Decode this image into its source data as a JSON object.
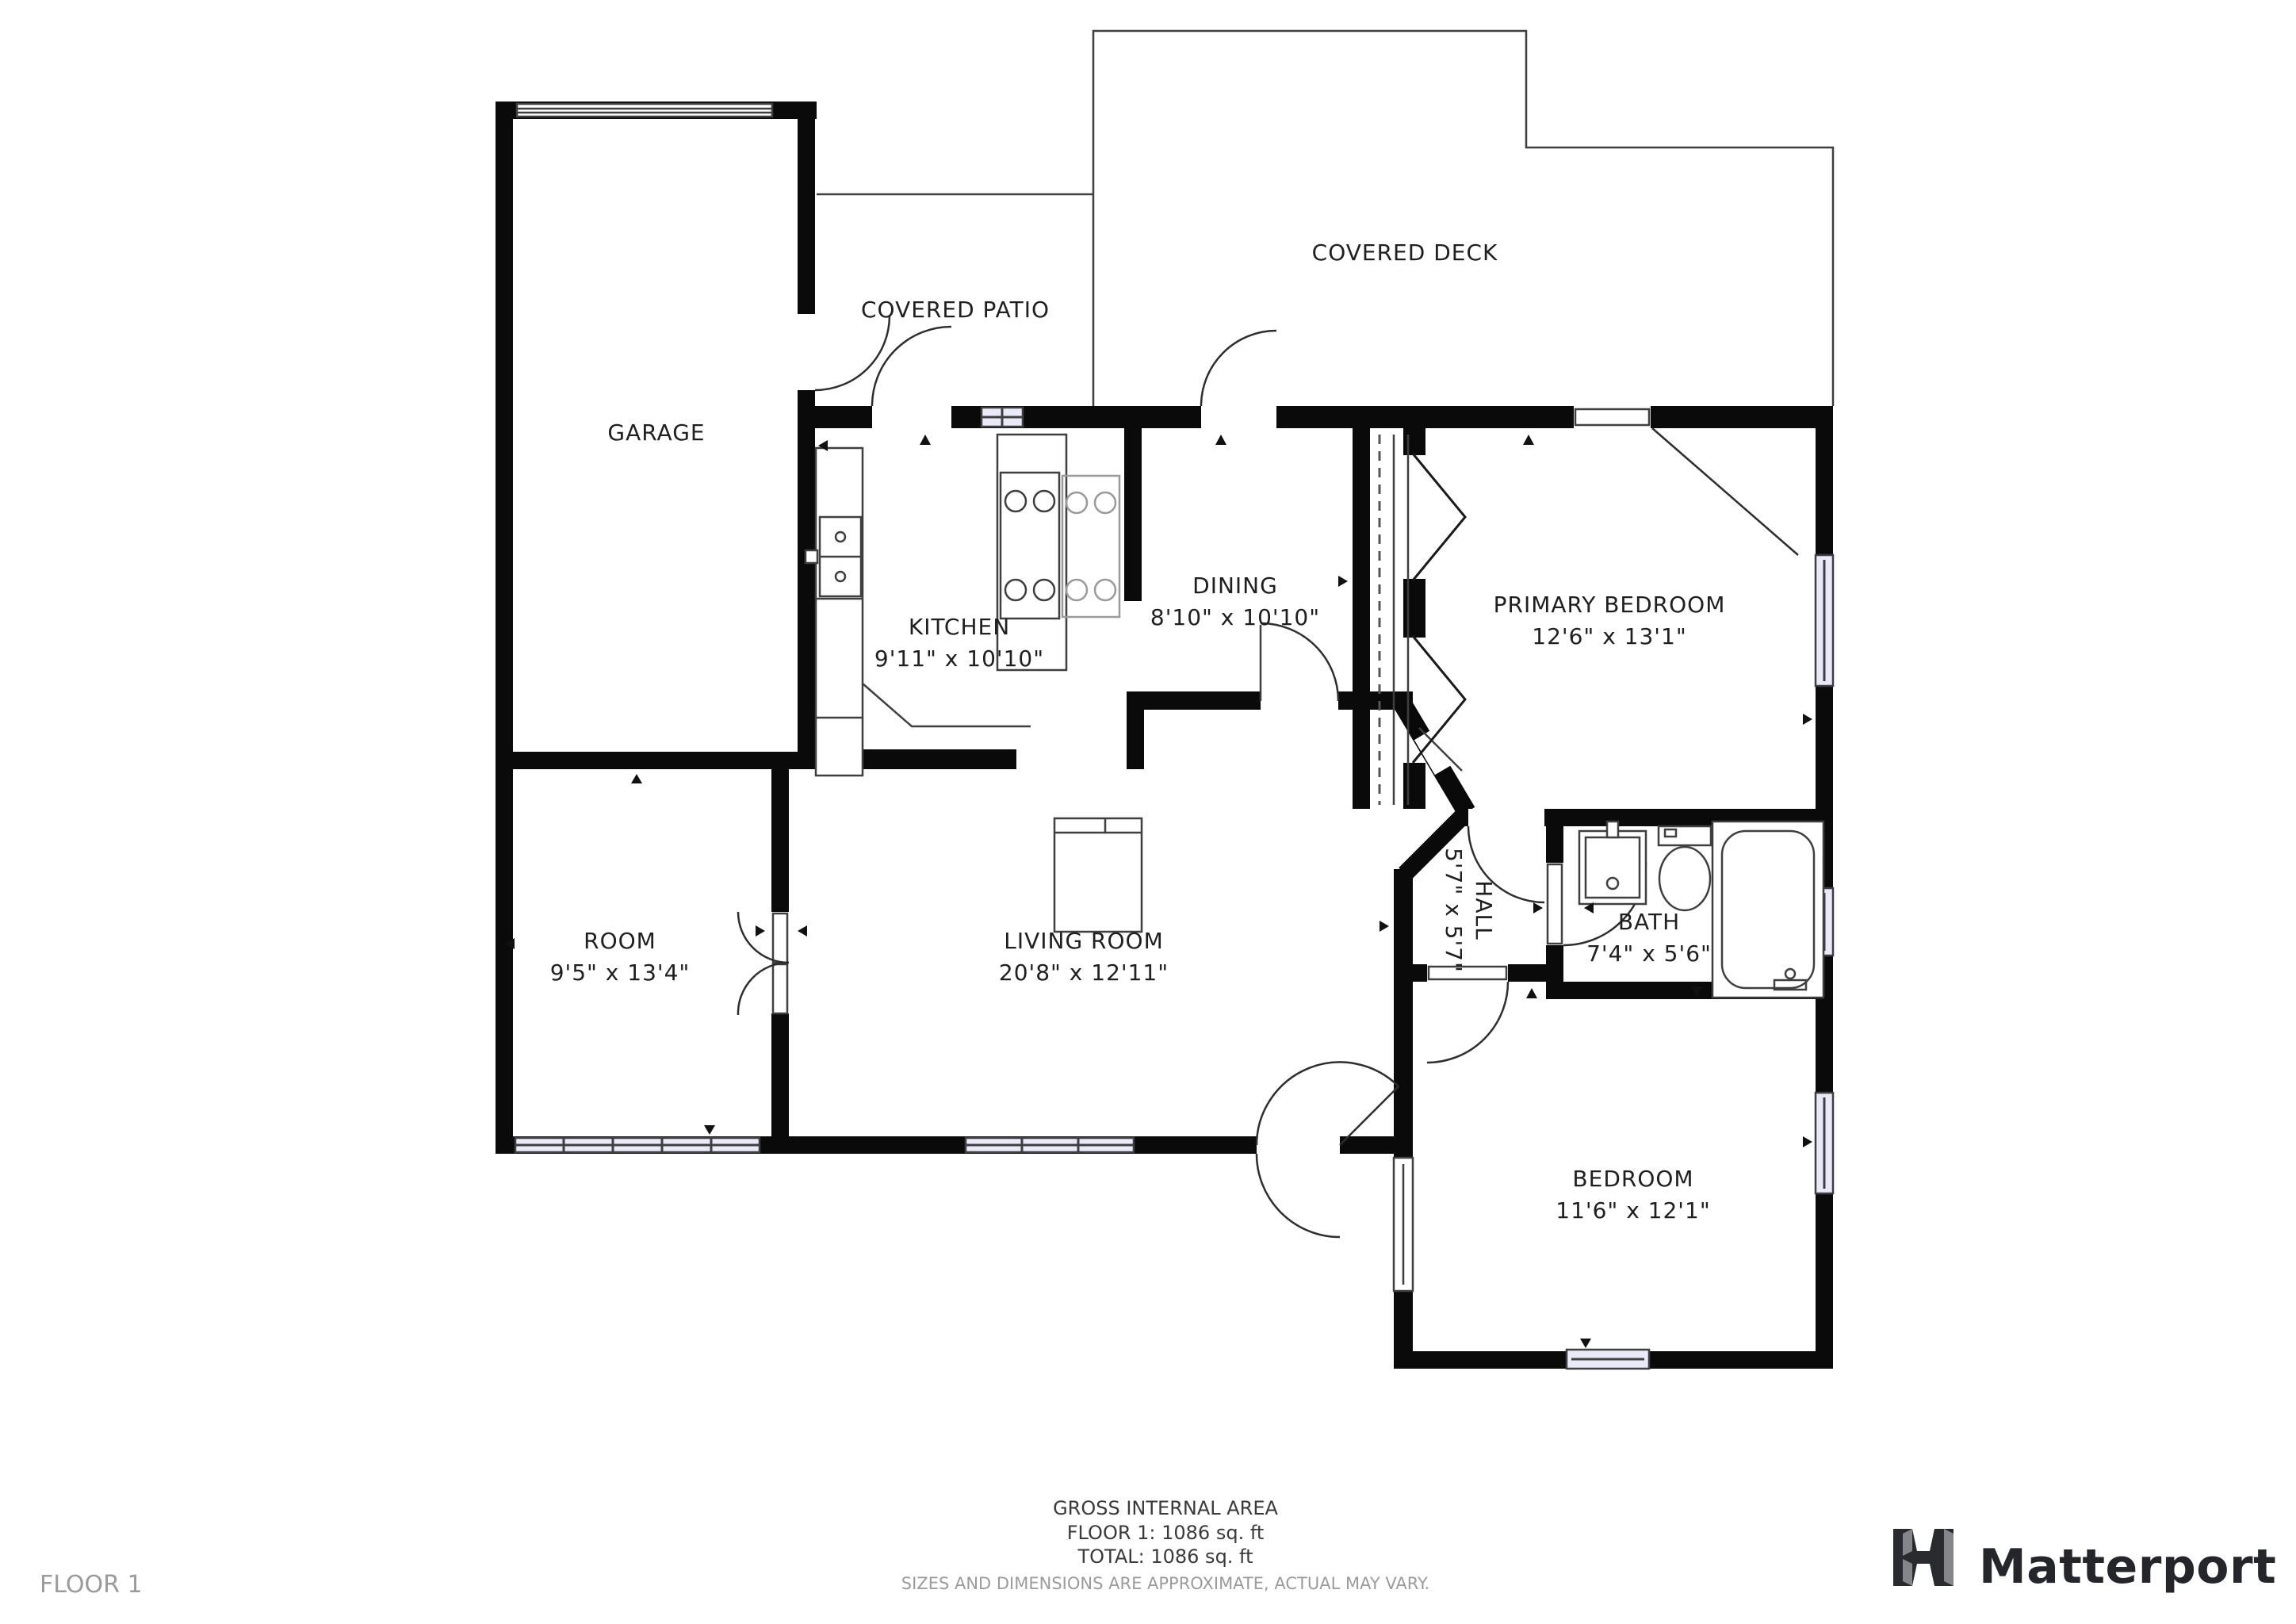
{
  "rooms": [
    {
      "name": "GARAGE",
      "dims": ""
    },
    {
      "name": "COVERED PATIO",
      "dims": ""
    },
    {
      "name": "COVERED DECK",
      "dims": ""
    },
    {
      "name": "KITCHEN",
      "dims": "9'11\" x 10'10\""
    },
    {
      "name": "DINING",
      "dims": "8'10\" x 10'10\""
    },
    {
      "name": "PRIMARY BEDROOM",
      "dims": "12'6\" x 13'1\""
    },
    {
      "name": "ROOM",
      "dims": "9'5\" x 13'4\""
    },
    {
      "name": "LIVING ROOM",
      "dims": "20'8\" x 12'11\""
    },
    {
      "name": "HALL",
      "dims": "5'7\" x 5'7\""
    },
    {
      "name": "BATH",
      "dims": "7'4\" x 5'6\""
    },
    {
      "name": "BEDROOM",
      "dims": "11'6\" x 12'1\""
    }
  ],
  "footer": {
    "gross_area_label": "GROSS INTERNAL AREA",
    "floor_area": "FLOOR 1: 1086 sq. ft",
    "total_area": "TOTAL: 1086 sq. ft",
    "disclaimer": "SIZES AND DIMENSIONS ARE APPROXIMATE, ACTUAL MAY VARY.",
    "floor_label": "FLOOR 1"
  },
  "branding": {
    "name": "Matterport"
  },
  "colors": {
    "wall": "#0a0a0a",
    "window_fill": "#e9e9f8",
    "line": "#3f3f3f",
    "text": "#1f1f1f",
    "muted_text": "#9b9b9b",
    "logo_text": "#25262b"
  }
}
